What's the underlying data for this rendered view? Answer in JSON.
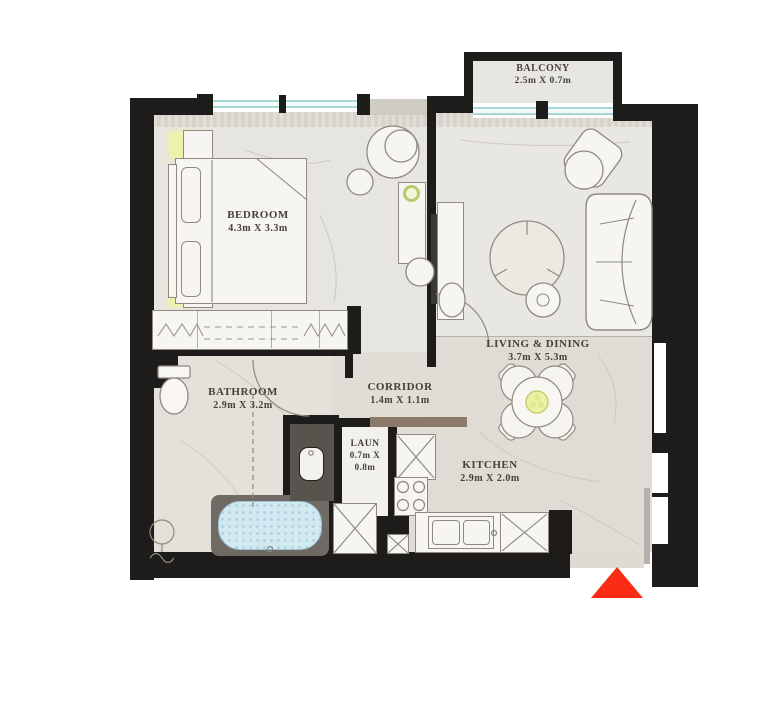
{
  "plan": {
    "type": "apartment-floor-plan",
    "colors": {
      "wall": "#1d1c1a",
      "floor_light": "#e7e5df",
      "floor_dark": "#dfdcd5",
      "glass": "#a6d6d6",
      "accent_yellow": "#ebf2ab",
      "bath_water": "#d3e9f1",
      "vanity_dark": "#57534d",
      "entrance_arrow": "#fa2c14",
      "label_text": "#45403a"
    },
    "rooms": [
      {
        "name": "BALCONY",
        "dims": "2.5m X 0.7m"
      },
      {
        "name": "BEDROOM",
        "dims": "4.3m X 3.3m"
      },
      {
        "name": "LIVING & DINING",
        "dims": "3.7m X 5.3m"
      },
      {
        "name": "BATHROOM",
        "dims": "2.9m X 3.2m"
      },
      {
        "name": "CORRIDOR",
        "dims": "1.4m X 1.1m"
      },
      {
        "name": "LAUN",
        "dims_l1": "0.7m X",
        "dims_l2": "0.8m"
      },
      {
        "name": "KITCHEN",
        "dims": "2.9m X 2.0m"
      }
    ]
  }
}
